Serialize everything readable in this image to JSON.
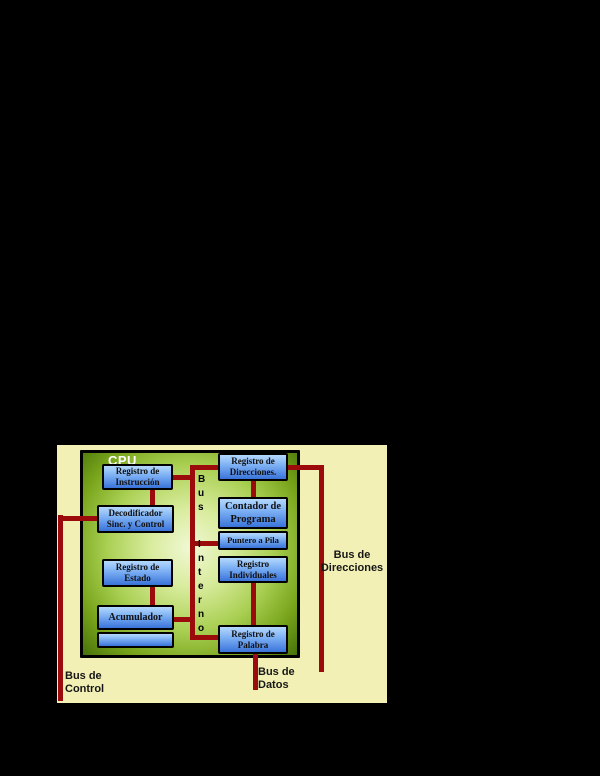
{
  "diagram": {
    "colors": {
      "background": "#000000",
      "panel": "#f3f0b6",
      "bus": "#9b0b0b",
      "box_blue_light": "#b5d9fd",
      "box_blue_dark": "#3a74da",
      "green_light": "#f0f8d4",
      "green_dark": "#47720a",
      "text": "#101010",
      "cpu_label": "#ffffff"
    },
    "cpu": {
      "label": "CPU"
    },
    "boxes": {
      "reg_instruccion": {
        "line1": "Registro de",
        "line2": "Instrucción"
      },
      "decodificador": {
        "line1": "Decodificador",
        "line2": "Sinc. y Control"
      },
      "reg_estado": {
        "line1": "Registro de",
        "line2": "Estado"
      },
      "acumulador": {
        "line1": "Acumulador"
      },
      "reg_direcciones": {
        "line1": "Registro de",
        "line2": "Direcciones."
      },
      "contador": {
        "line1": "Contador de",
        "line2": "Programa"
      },
      "puntero": {
        "line1": "Puntero a Pila"
      },
      "reg_individuales": {
        "line1": "Registro",
        "line2": "Individuales"
      },
      "reg_palabra": {
        "line1": "Registro de",
        "line2": "Palabra"
      }
    },
    "internal_bus": {
      "bus": [
        "B",
        "u",
        "s"
      ],
      "interno": [
        "I",
        "n",
        "t",
        "e",
        "r",
        "n",
        "o"
      ]
    },
    "labels": {
      "direcciones": {
        "line1": "Bus de",
        "line2": "Direcciones"
      },
      "control": {
        "line1": "Bus de",
        "line2": "Control"
      },
      "datos": {
        "line1": "Bus de",
        "line2": "Datos"
      }
    }
  }
}
